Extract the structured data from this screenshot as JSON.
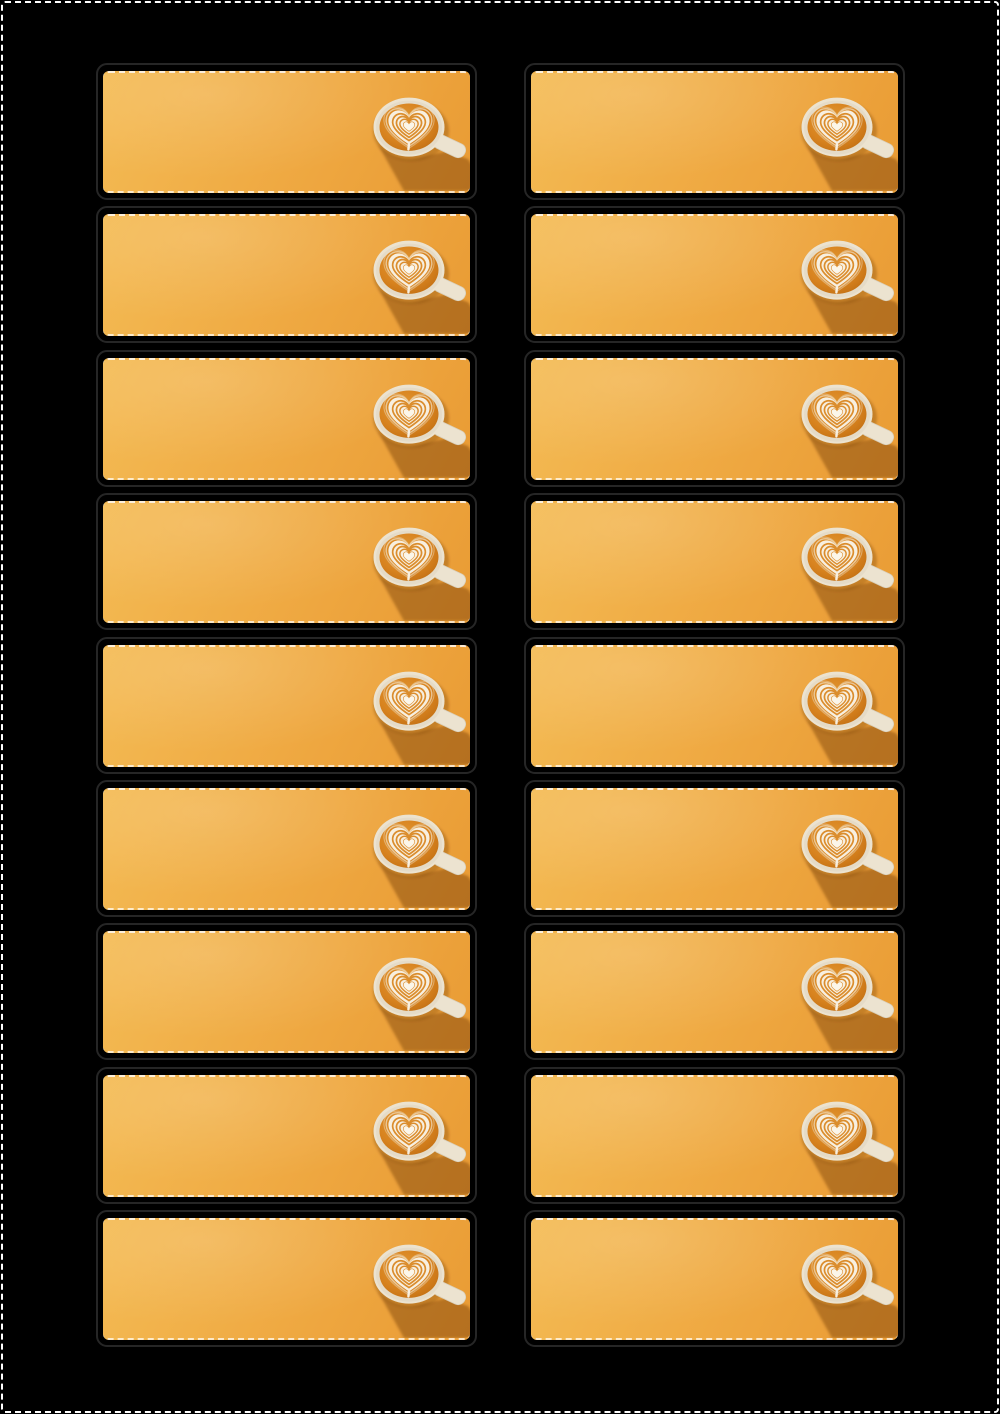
{
  "page": {
    "kind": "printable-label-sheet",
    "border_style": "dashed-crop-marks"
  },
  "sheet": {
    "rows": 9,
    "columns": 2,
    "card_text": "",
    "cards": [
      {
        "row": 1,
        "col": 1
      },
      {
        "row": 1,
        "col": 2
      },
      {
        "row": 2,
        "col": 1
      },
      {
        "row": 2,
        "col": 2
      },
      {
        "row": 3,
        "col": 1
      },
      {
        "row": 3,
        "col": 2
      },
      {
        "row": 4,
        "col": 1
      },
      {
        "row": 4,
        "col": 2
      },
      {
        "row": 5,
        "col": 1
      },
      {
        "row": 5,
        "col": 2
      },
      {
        "row": 6,
        "col": 1
      },
      {
        "row": 6,
        "col": 2
      },
      {
        "row": 7,
        "col": 1
      },
      {
        "row": 7,
        "col": 2
      },
      {
        "row": 8,
        "col": 1
      },
      {
        "row": 8,
        "col": 2
      },
      {
        "row": 9,
        "col": 1
      },
      {
        "row": 9,
        "col": 2
      }
    ]
  },
  "icons": {
    "latte_cup": "latte-cup-heart-art-photo"
  },
  "colors": {
    "page_background": "#000000",
    "page_border": "#ffffff",
    "card_outline": "#262626",
    "card_bg_start": "#f4bb54",
    "card_bg_mid": "#efa942",
    "card_bg_end": "#e99b34",
    "cup_rim": "#ece3d0",
    "cup_rim_shade": "#ddd2b9",
    "coffee_light": "#e29a35",
    "coffee_mid": "#d8831f",
    "coffee_dark": "#bc6a10",
    "latte_cream": "#f7efe0",
    "latte_cream_bright": "#fbf6ea",
    "heart_line": "#db8d2d",
    "shadow": "rgba(104,50,3,0.40)",
    "contact_shadow": "rgba(110,55,5,0.30)"
  }
}
